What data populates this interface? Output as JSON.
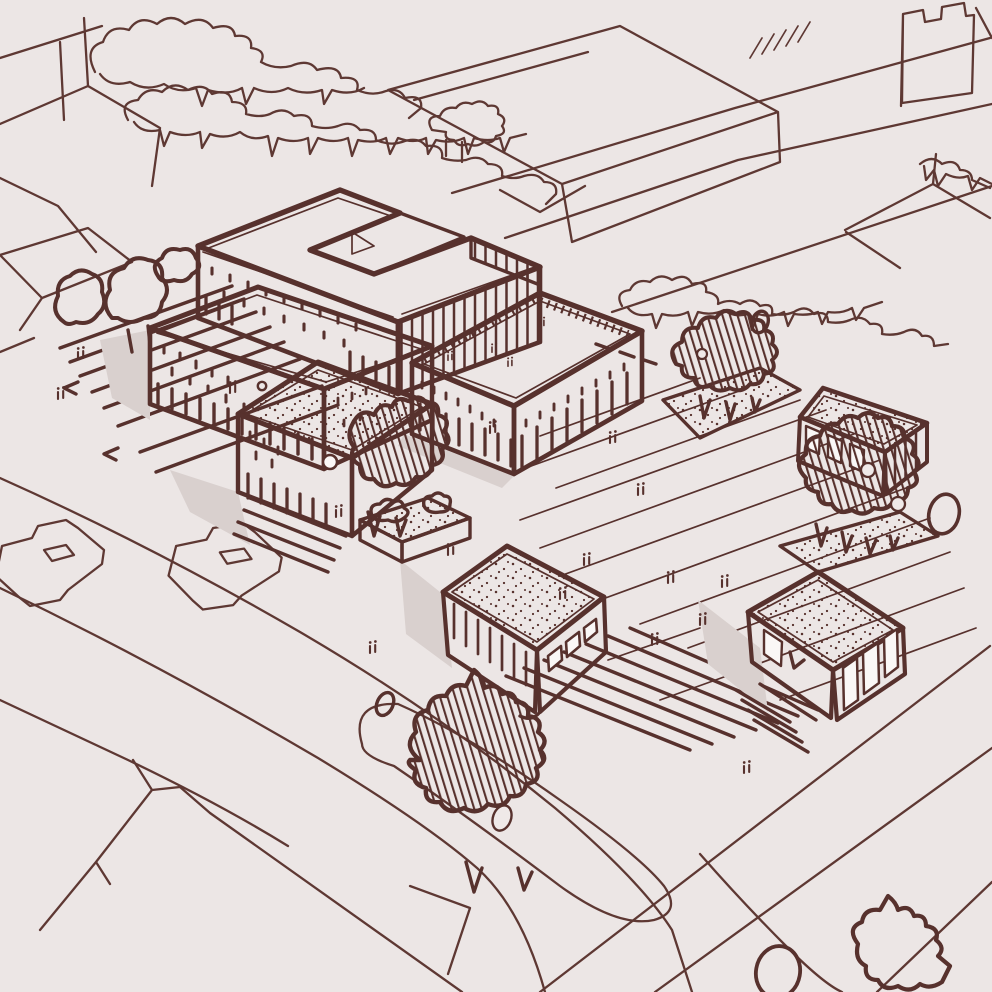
{
  "scene": {
    "title": "Hand-drawn architectural masterplan sketch",
    "description": "Aerial axonometric freehand ink sketch of a campus site: a U-shaped courtyard block and slab buildings at the top, an arcaded central hall, small flat-roofed pavilions with stippled roofs, hatched trees and planting beds, stepped plaza edges, curving roads with two sketched cars, and loose background buildings and tree rows.",
    "medium": "maroon ink line drawing on warm gray paper",
    "palette": {
      "paper": "#ece6e5",
      "ink": "#57312d",
      "ink_light": "#5e3833",
      "facade_gray": "#cdc3c0",
      "facade_light": "#ddd5d2",
      "roof_white": "#faf7f6",
      "courtyard_gray": "#c8bebb",
      "shadow_gray": "#d9d0ce",
      "bed_gray": "#e7e0de"
    }
  },
  "site": {
    "buildings": [
      {
        "id": "u-block",
        "name": "U-shaped courtyard block",
        "position": "top of site",
        "roof": "white parapet roof",
        "facade": "gray with rows of window dots and vertical louver stripes",
        "courtyard": "recessed gray courtyard opening north-east"
      },
      {
        "id": "west-slab",
        "name": "West slab building",
        "position": "left",
        "roof": "white parapet roof",
        "facade": "gray with window dots and ground-floor arcade strips"
      },
      {
        "id": "central-hall",
        "name": "Central hall",
        "position": "middle",
        "roof": "white roof with hatched parapet rim",
        "facade": "light arcade columns with small paired windows"
      },
      {
        "id": "front-pavilion",
        "name": "Front pavilion",
        "position": "lower left of center",
        "roof": "stippled flat roof",
        "facade": "gray with strip windows and one round window"
      },
      {
        "id": "south-pavilion",
        "name": "South pavilion",
        "position": "bottom center",
        "roof": "stippled flat roof",
        "facade": "glazed with square windows and vertical mullions"
      },
      {
        "id": "east-pavilion-north",
        "name": "North-east pavilion",
        "position": "right",
        "roof": "stippled flat roof",
        "facade": "paneled gray"
      },
      {
        "id": "east-pavilion-south",
        "name": "South-east pavilion",
        "position": "lower right",
        "roof": "stippled flat roof",
        "facade": "glazed panels with entry steps"
      }
    ],
    "landscape": {
      "trees_hatched": 7,
      "shrub_clusters": 3,
      "planting_beds": 3,
      "stepped_edges": [
        "west stair flight",
        "front pavilion steps",
        "south-east plaza steps",
        "pavilion entry steps"
      ],
      "plaza": "large paved plaza with diagonal paving lines, scattered double-tick people marks and dashes"
    },
    "vehicles": [
      {
        "type": "car",
        "position": "left road upper"
      },
      {
        "type": "car",
        "position": "left road lower"
      }
    ]
  },
  "context": {
    "background_buildings": [
      "top-left block outlines",
      "large top-center block",
      "notched top-right block",
      "small right block",
      "bottom-left gabled plots"
    ],
    "tree_rows": [
      "upper-left double scribble row with drips",
      "long middle scribble row",
      "right road scribble row"
    ],
    "roads": [
      "upper-right diagonal road with crosswalk ticks",
      "left curving boulevard with traffic island",
      "lower-right diagonal road"
    ]
  },
  "annotations": {
    "people_tick_marks": 16,
    "road_dashes": "short dash marks where the rear road passes behind the plaza",
    "text_visible": "none"
  }
}
